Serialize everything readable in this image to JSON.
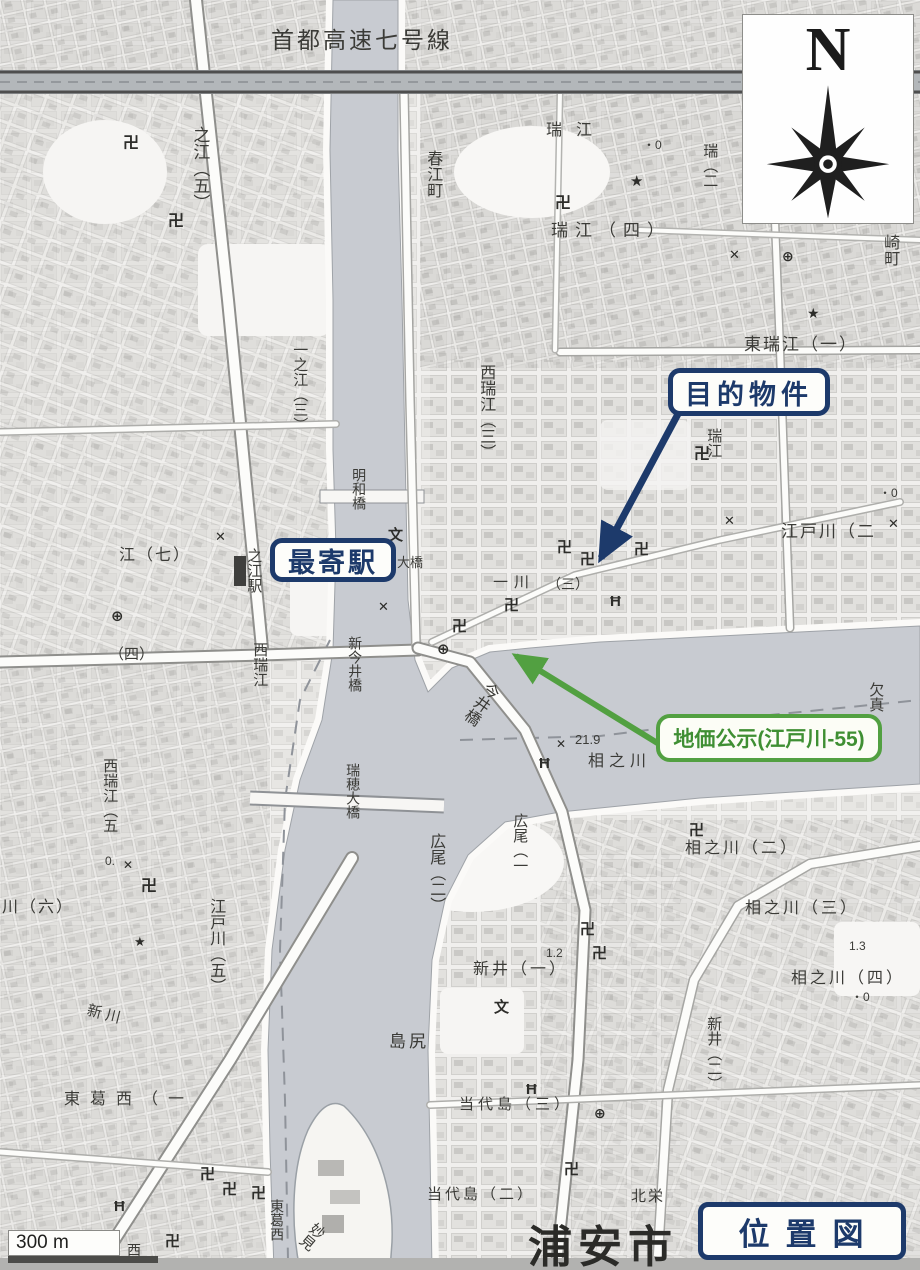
{
  "title_box": {
    "label": "位置図"
  },
  "compass": {
    "north_label": "N"
  },
  "scale_bar": {
    "label": "300 m"
  },
  "callouts": {
    "target_property": {
      "label": "目的物件",
      "color": "#1d3a6b"
    },
    "nearest_station": {
      "label": "最寄駅",
      "color": "#1d3a6b"
    },
    "land_price": {
      "label": "地価公示(江戸川-55)",
      "color": "#52a041"
    }
  },
  "colors": {
    "callout_navy": "#1d3a6b",
    "callout_green": "#52a041",
    "river_gray": "#c8cbd1",
    "map_text": "#3b3b37"
  },
  "map": {
    "region_labels": [
      {
        "t": "首都高速七号線",
        "x": 271,
        "y": 28,
        "s": 23,
        "o": "h",
        "ls": 3
      },
      {
        "t": "之江（五）",
        "x": 190,
        "y": 126,
        "s": 17,
        "o": "v"
      },
      {
        "t": "春江町",
        "x": 424,
        "y": 150,
        "s": 16,
        "o": "v"
      },
      {
        "t": "瑞江",
        "x": 546,
        "y": 122,
        "s": 16,
        "o": "h",
        "ls": 14
      },
      {
        "t": "瑞江（四）",
        "x": 551,
        "y": 222,
        "s": 17,
        "o": "h",
        "ls": 7
      },
      {
        "t": "瑞（二",
        "x": 701,
        "y": 143,
        "s": 15,
        "o": "v"
      },
      {
        "t": "崎町",
        "x": 881,
        "y": 234,
        "s": 16,
        "o": "v"
      },
      {
        "t": "東瑞江（一）",
        "x": 744,
        "y": 336,
        "s": 17,
        "o": "h",
        "ls": 2
      },
      {
        "t": "西瑞江（三）",
        "x": 477,
        "y": 364,
        "s": 16,
        "o": "v"
      },
      {
        "t": "瑞江",
        "x": 705,
        "y": 428,
        "s": 15,
        "o": "v"
      },
      {
        "t": "江戸川（二",
        "x": 781,
        "y": 523,
        "s": 17,
        "o": "h",
        "ls": 2
      },
      {
        "t": "江（七）",
        "x": 119,
        "y": 547,
        "s": 16,
        "o": "h",
        "ls": 2
      },
      {
        "t": "之江駅",
        "x": 245,
        "y": 548,
        "s": 15,
        "o": "v"
      },
      {
        "t": "一之江（三）",
        "x": 291,
        "y": 342,
        "s": 15,
        "o": "v"
      },
      {
        "t": "明和橋",
        "x": 351,
        "y": 468,
        "s": 14,
        "o": "v"
      },
      {
        "t": "大橋",
        "x": 397,
        "y": 556,
        "s": 13,
        "o": "h"
      },
      {
        "t": "一川",
        "x": 493,
        "y": 575,
        "s": 15,
        "o": "h",
        "ls": 6
      },
      {
        "t": "（三）",
        "x": 547,
        "y": 577,
        "s": 14,
        "o": "h"
      },
      {
        "t": "（四）",
        "x": 109,
        "y": 647,
        "s": 15,
        "o": "h"
      },
      {
        "t": "西瑞江",
        "x": 251,
        "y": 642,
        "s": 15,
        "o": "v"
      },
      {
        "t": "西瑞江（五",
        "x": 101,
        "y": 758,
        "s": 15,
        "o": "v"
      },
      {
        "t": "新今井橋",
        "x": 347,
        "y": 636,
        "s": 14,
        "o": "v"
      },
      {
        "t": "瑞穂大橋",
        "x": 345,
        "y": 763,
        "s": 14,
        "o": "v"
      },
      {
        "t": "今井橋",
        "x": 487,
        "y": 678,
        "s": 16,
        "o": "v",
        "r": 35
      },
      {
        "t": "21.9",
        "x": 575,
        "y": 733,
        "s": 13,
        "o": "h"
      },
      {
        "t": "相之川",
        "x": 588,
        "y": 753,
        "s": 16,
        "o": "h",
        "ls": 5
      },
      {
        "t": "相之川（二）",
        "x": 685,
        "y": 840,
        "s": 16,
        "o": "h",
        "ls": 3
      },
      {
        "t": "相之川（三）",
        "x": 745,
        "y": 900,
        "s": 16,
        "o": "h",
        "ls": 3
      },
      {
        "t": "相之川（四）",
        "x": 791,
        "y": 970,
        "s": 16,
        "o": "h",
        "ls": 3
      },
      {
        "t": "欠真",
        "x": 867,
        "y": 682,
        "s": 15,
        "o": "v"
      },
      {
        "t": "川（六）",
        "x": 2,
        "y": 899,
        "s": 16,
        "o": "h",
        "ls": 2
      },
      {
        "t": "江戸川（五）",
        "x": 207,
        "y": 898,
        "s": 16,
        "o": "v"
      },
      {
        "t": "新川",
        "x": 89,
        "y": 1003,
        "s": 15,
        "o": "h",
        "r": 14,
        "ls": 4
      },
      {
        "t": "東葛西（一",
        "x": 64,
        "y": 1091,
        "s": 16,
        "o": "h",
        "ls": 10
      },
      {
        "t": "広尾（二）",
        "x": 427,
        "y": 833,
        "s": 16,
        "o": "v"
      },
      {
        "t": "広尾（一",
        "x": 511,
        "y": 813,
        "s": 15,
        "o": "v"
      },
      {
        "t": "新井（一）",
        "x": 473,
        "y": 961,
        "s": 16,
        "o": "h",
        "ls": 3
      },
      {
        "t": "島尻",
        "x": 389,
        "y": 1033,
        "s": 17,
        "o": "h",
        "ls": 3
      },
      {
        "t": "1.2",
        "x": 546,
        "y": 947,
        "s": 12,
        "o": "h"
      },
      {
        "t": "新井（二）",
        "x": 705,
        "y": 1016,
        "s": 15,
        "o": "v"
      },
      {
        "t": "1.3",
        "x": 849,
        "y": 940,
        "s": 12,
        "o": "h"
      },
      {
        "t": "当代島（三）",
        "x": 459,
        "y": 1097,
        "s": 15,
        "o": "h",
        "ls": 4
      },
      {
        "t": "当代島（二）",
        "x": 427,
        "y": 1187,
        "s": 15,
        "o": "h",
        "ls": 3
      },
      {
        "t": "北栄",
        "x": 631,
        "y": 1189,
        "s": 15,
        "o": "h",
        "ls": 2
      },
      {
        "t": "浦安市",
        "x": 528,
        "y": 1224,
        "s": 44,
        "o": "h",
        "ls": 6,
        "b": 1,
        "c": "#2b2b28"
      },
      {
        "t": "東葛西",
        "x": 269,
        "y": 1199,
        "s": 14,
        "o": "v"
      },
      {
        "t": "妙見",
        "x": 315,
        "y": 1219,
        "s": 15,
        "o": "v",
        "r": 40
      },
      {
        "t": "西",
        "x": 127,
        "y": 1243,
        "s": 14,
        "o": "h"
      },
      {
        "t": "・0",
        "x": 643,
        "y": 139,
        "s": 12,
        "o": "h"
      },
      {
        "t": "・0",
        "x": 879,
        "y": 487,
        "s": 12,
        "o": "h"
      },
      {
        "t": "・0",
        "x": 851,
        "y": 991,
        "s": 12,
        "o": "h"
      },
      {
        "t": "0.",
        "x": 105,
        "y": 855,
        "s": 12,
        "o": "h"
      }
    ],
    "symbol_names": {
      "卍": "temple-symbol",
      "文": "school-symbol",
      "✕": "crossing-mark-symbol",
      "★": "landmark-star-symbol",
      "Ħ": "shrine-torii-symbol",
      "⊕": "public-office-symbol"
    },
    "symbols": [
      {
        "g": "卍",
        "x": 123,
        "y": 136,
        "s": 16
      },
      {
        "g": "卍",
        "x": 168,
        "y": 214,
        "s": 16
      },
      {
        "g": "卍",
        "x": 555,
        "y": 196,
        "s": 16
      },
      {
        "g": "卍",
        "x": 694,
        "y": 447,
        "s": 16
      },
      {
        "g": "卍",
        "x": 634,
        "y": 542,
        "s": 15
      },
      {
        "g": "卍",
        "x": 557,
        "y": 540,
        "s": 15
      },
      {
        "g": "卍",
        "x": 580,
        "y": 552,
        "s": 15
      },
      {
        "g": "卍",
        "x": 504,
        "y": 598,
        "s": 15
      },
      {
        "g": "卍",
        "x": 452,
        "y": 619,
        "s": 15
      },
      {
        "g": "卍",
        "x": 141,
        "y": 879,
        "s": 16
      },
      {
        "g": "卍",
        "x": 580,
        "y": 922,
        "s": 15
      },
      {
        "g": "卍",
        "x": 592,
        "y": 946,
        "s": 15
      },
      {
        "g": "卍",
        "x": 689,
        "y": 823,
        "s": 15
      },
      {
        "g": "卍",
        "x": 564,
        "y": 1162,
        "s": 15
      },
      {
        "g": "卍",
        "x": 200,
        "y": 1167,
        "s": 15
      },
      {
        "g": "卍",
        "x": 222,
        "y": 1182,
        "s": 15
      },
      {
        "g": "卍",
        "x": 251,
        "y": 1186,
        "s": 15
      },
      {
        "g": "卍",
        "x": 165,
        "y": 1234,
        "s": 15
      },
      {
        "g": "文",
        "x": 388,
        "y": 528,
        "s": 15
      },
      {
        "g": "文",
        "x": 494,
        "y": 1000,
        "s": 15
      },
      {
        "g": "✕",
        "x": 724,
        "y": 514,
        "s": 13
      },
      {
        "g": "✕",
        "x": 378,
        "y": 600,
        "s": 13
      },
      {
        "g": "✕",
        "x": 215,
        "y": 530,
        "s": 13
      },
      {
        "g": "✕",
        "x": 729,
        "y": 248,
        "s": 13
      },
      {
        "g": "✕",
        "x": 123,
        "y": 859,
        "s": 12
      },
      {
        "g": "✕",
        "x": 556,
        "y": 738,
        "s": 12
      },
      {
        "g": "✕",
        "x": 888,
        "y": 517,
        "s": 13
      },
      {
        "g": "★",
        "x": 630,
        "y": 174,
        "s": 15
      },
      {
        "g": "★",
        "x": 807,
        "y": 306,
        "s": 14
      },
      {
        "g": "★",
        "x": 134,
        "y": 935,
        "s": 13
      },
      {
        "g": "Ħ",
        "x": 610,
        "y": 594,
        "s": 15
      },
      {
        "g": "Ħ",
        "x": 539,
        "y": 756,
        "s": 15
      },
      {
        "g": "Ħ",
        "x": 114,
        "y": 1199,
        "s": 15
      },
      {
        "g": "Ħ",
        "x": 526,
        "y": 1082,
        "s": 15
      },
      {
        "g": "⊕",
        "x": 437,
        "y": 642,
        "s": 15
      },
      {
        "g": "⊕",
        "x": 111,
        "y": 609,
        "s": 15
      },
      {
        "g": "⊕",
        "x": 594,
        "y": 1106,
        "s": 14
      },
      {
        "g": "⊕",
        "x": 782,
        "y": 249,
        "s": 14
      }
    ]
  }
}
